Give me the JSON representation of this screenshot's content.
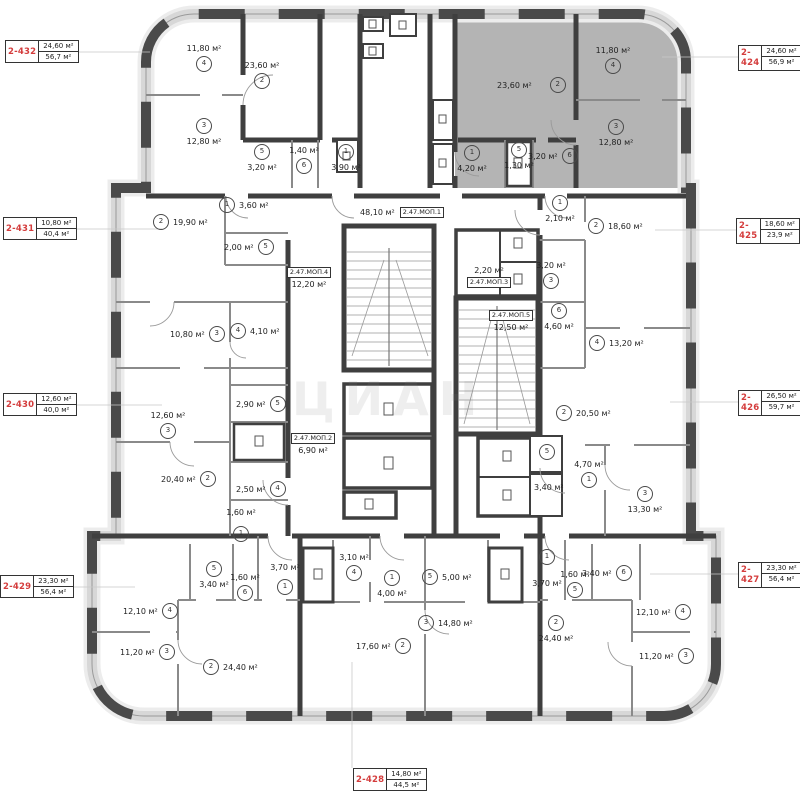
{
  "unit": "м²",
  "watermark": "ЦИАН",
  "colors": {
    "tag_red": "#d43c3c",
    "highlight_gray": "#b4b4b4",
    "wall_dark": "#3f3f3f"
  },
  "apartments": [
    {
      "number": "2-432",
      "area_top": "24,60 м²",
      "area_bottom": "56,7 м²"
    },
    {
      "number": "2-431",
      "area_top": "10,80 м²",
      "area_bottom": "40,4 м²"
    },
    {
      "number": "2-430",
      "area_top": "12,60 м²",
      "area_bottom": "40,0 м²"
    },
    {
      "number": "2-429",
      "area_top": "23,30 м²",
      "area_bottom": "56,4 м²"
    },
    {
      "number": "2-424",
      "area_top": "24,60 м²",
      "area_bottom": "56,9 м²"
    },
    {
      "number": "2-425",
      "area_top": "18,60 м²",
      "area_bottom": "23,9 м²"
    },
    {
      "number": "2-426",
      "area_top": "26,50 м²",
      "area_bottom": "59,7 м²"
    },
    {
      "number": "2-427",
      "area_top": "23,30 м²",
      "area_bottom": "56,4 м²"
    },
    {
      "number": "2-428",
      "area_top": "14,80 м²",
      "area_bottom": "44,5 м²"
    }
  ],
  "mop": {
    "label1": "2.47.МОП.1",
    "area1": "48,10 м²",
    "label2": "2.47.МОП.2",
    "area2": "6,90 м²",
    "label3": "2.47.МОП.3",
    "area3": "2,20 м²",
    "label4": "2.47.МОП.4",
    "area4": "12,20 м²",
    "label5": "2.47.МОП.5",
    "area5": "12,50 м²"
  },
  "rooms": [
    {
      "n": "4",
      "a": "11,80 м²"
    },
    {
      "n": "2",
      "a": "23,60 м²"
    },
    {
      "n": "3",
      "a": "12,80 м²"
    },
    {
      "n": "5",
      "a": "3,20 м²"
    },
    {
      "n": "6",
      "a": "1,40 м²"
    },
    {
      "n": "1",
      "a": "3,90 м²"
    },
    {
      "n": "2",
      "a": "23,60 м²"
    },
    {
      "n": "4",
      "a": "11,80 м²"
    },
    {
      "n": "3",
      "a": "12,80 м²"
    },
    {
      "n": "1",
      "a": "4,20 м²"
    },
    {
      "n": "5",
      "a": "1,30 м²"
    },
    {
      "n": "6",
      "a": "3,20 м²"
    },
    {
      "n": "1",
      "a": "3,60 м²"
    },
    {
      "n": "2",
      "a": "19,90 м²"
    },
    {
      "n": "5",
      "a": "2,00 м²"
    },
    {
      "n": "3",
      "a": "10,80 м²"
    },
    {
      "n": "4",
      "a": "4,10 м²"
    },
    {
      "n": "5",
      "a": "2,90 м²"
    },
    {
      "n": "3",
      "a": "12,60 м²"
    },
    {
      "n": "2",
      "a": "20,40 м²"
    },
    {
      "n": "4",
      "a": "2,50 м²"
    },
    {
      "n": "1",
      "a": "1,60 м²"
    },
    {
      "n": "5",
      "a": "3,40 м²"
    },
    {
      "n": "6",
      "a": "1,60 м²"
    },
    {
      "n": "4",
      "a": "12,10 м²"
    },
    {
      "n": "3",
      "a": "11,20 м²"
    },
    {
      "n": "1",
      "a": "3,70 м²"
    },
    {
      "n": "2",
      "a": "24,40 м²"
    },
    {
      "n": "4",
      "a": "3,10 м²"
    },
    {
      "n": "1",
      "a": "4,00 м²"
    },
    {
      "n": "5",
      "a": "5,00 м²"
    },
    {
      "n": "3",
      "a": "14,80 м²"
    },
    {
      "n": "2",
      "a": "17,60 м²"
    },
    {
      "n": "1",
      "a": "3,70 м²"
    },
    {
      "n": "5",
      "a": "1,60 м²"
    },
    {
      "n": "6",
      "a": "3,40 м²"
    },
    {
      "n": "4",
      "a": "12,10 м²"
    },
    {
      "n": "3",
      "a": "11,20 м²"
    },
    {
      "n": "2",
      "a": "24,40 м²"
    },
    {
      "n": "2",
      "a": "20,50 м²"
    },
    {
      "n": "5",
      "a": ""
    },
    {
      "n": "1",
      "a": "4,70 м²"
    },
    {
      "n": "",
      "a": "3,40 м²"
    },
    {
      "n": "3",
      "a": "13,30 м²"
    },
    {
      "n": "6",
      "a": "4,60 м²"
    },
    {
      "n": "4",
      "a": "13,20 м²"
    },
    {
      "n": "1",
      "a": "2,10 м²"
    },
    {
      "n": "2",
      "a": "18,60 м²"
    },
    {
      "n": "3",
      "a": "3,20 м²"
    }
  ]
}
